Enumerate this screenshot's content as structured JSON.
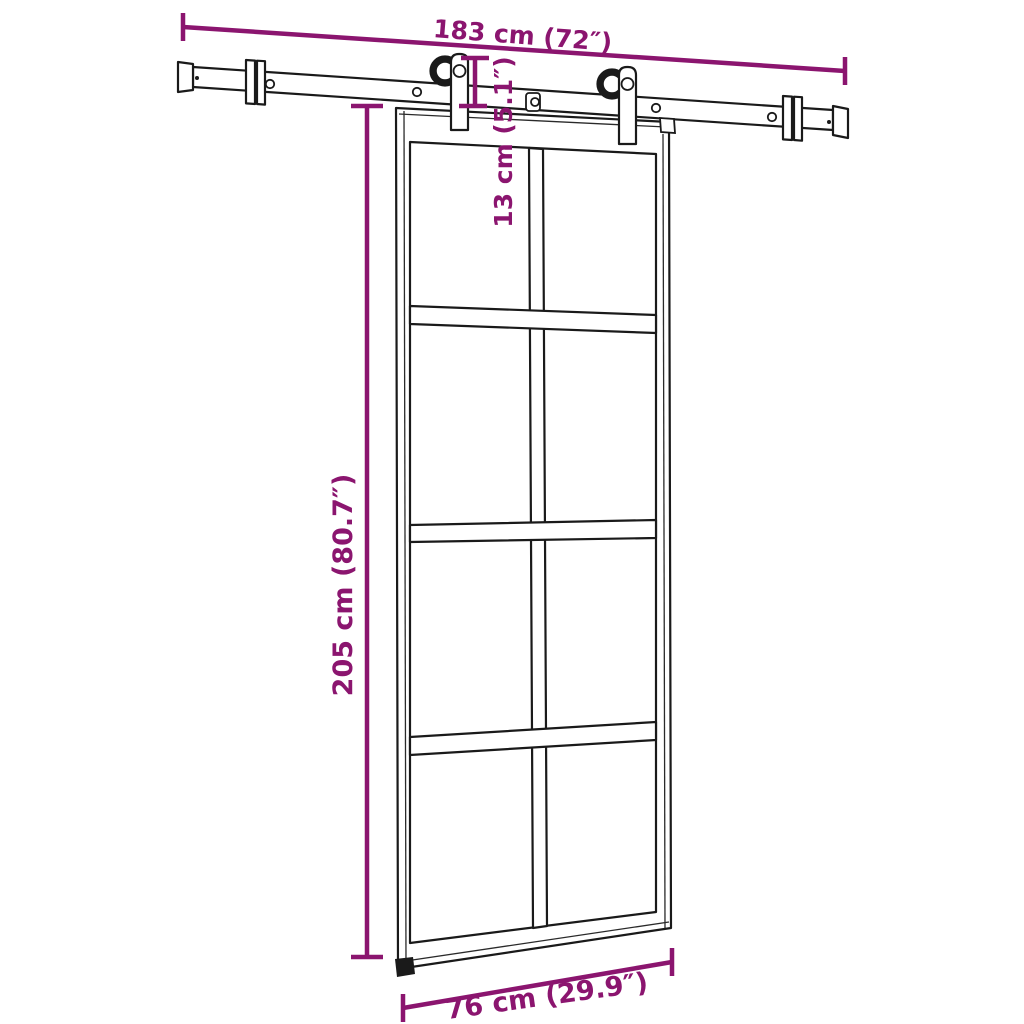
{
  "diagram": {
    "style": {
      "dimension_color": "#8B156F",
      "drawing_color": "#1A1A1A",
      "background": "#FFFFFF"
    },
    "dimensions": {
      "rail_width": {
        "label": "183 cm (72″)",
        "value_cm": "183 cm",
        "value_in": "72″"
      },
      "hanger_drop": {
        "label": "13 cm (5.1″)",
        "value_cm": "13 cm",
        "value_in": "5.1″"
      },
      "door_height": {
        "label": "205 cm (80.7″)",
        "value_cm": "205 cm",
        "value_in": "80.7″"
      },
      "door_width": {
        "label": "76 cm (29.9″)",
        "value_cm": "76 cm",
        "value_in": "29.9″"
      }
    }
  }
}
